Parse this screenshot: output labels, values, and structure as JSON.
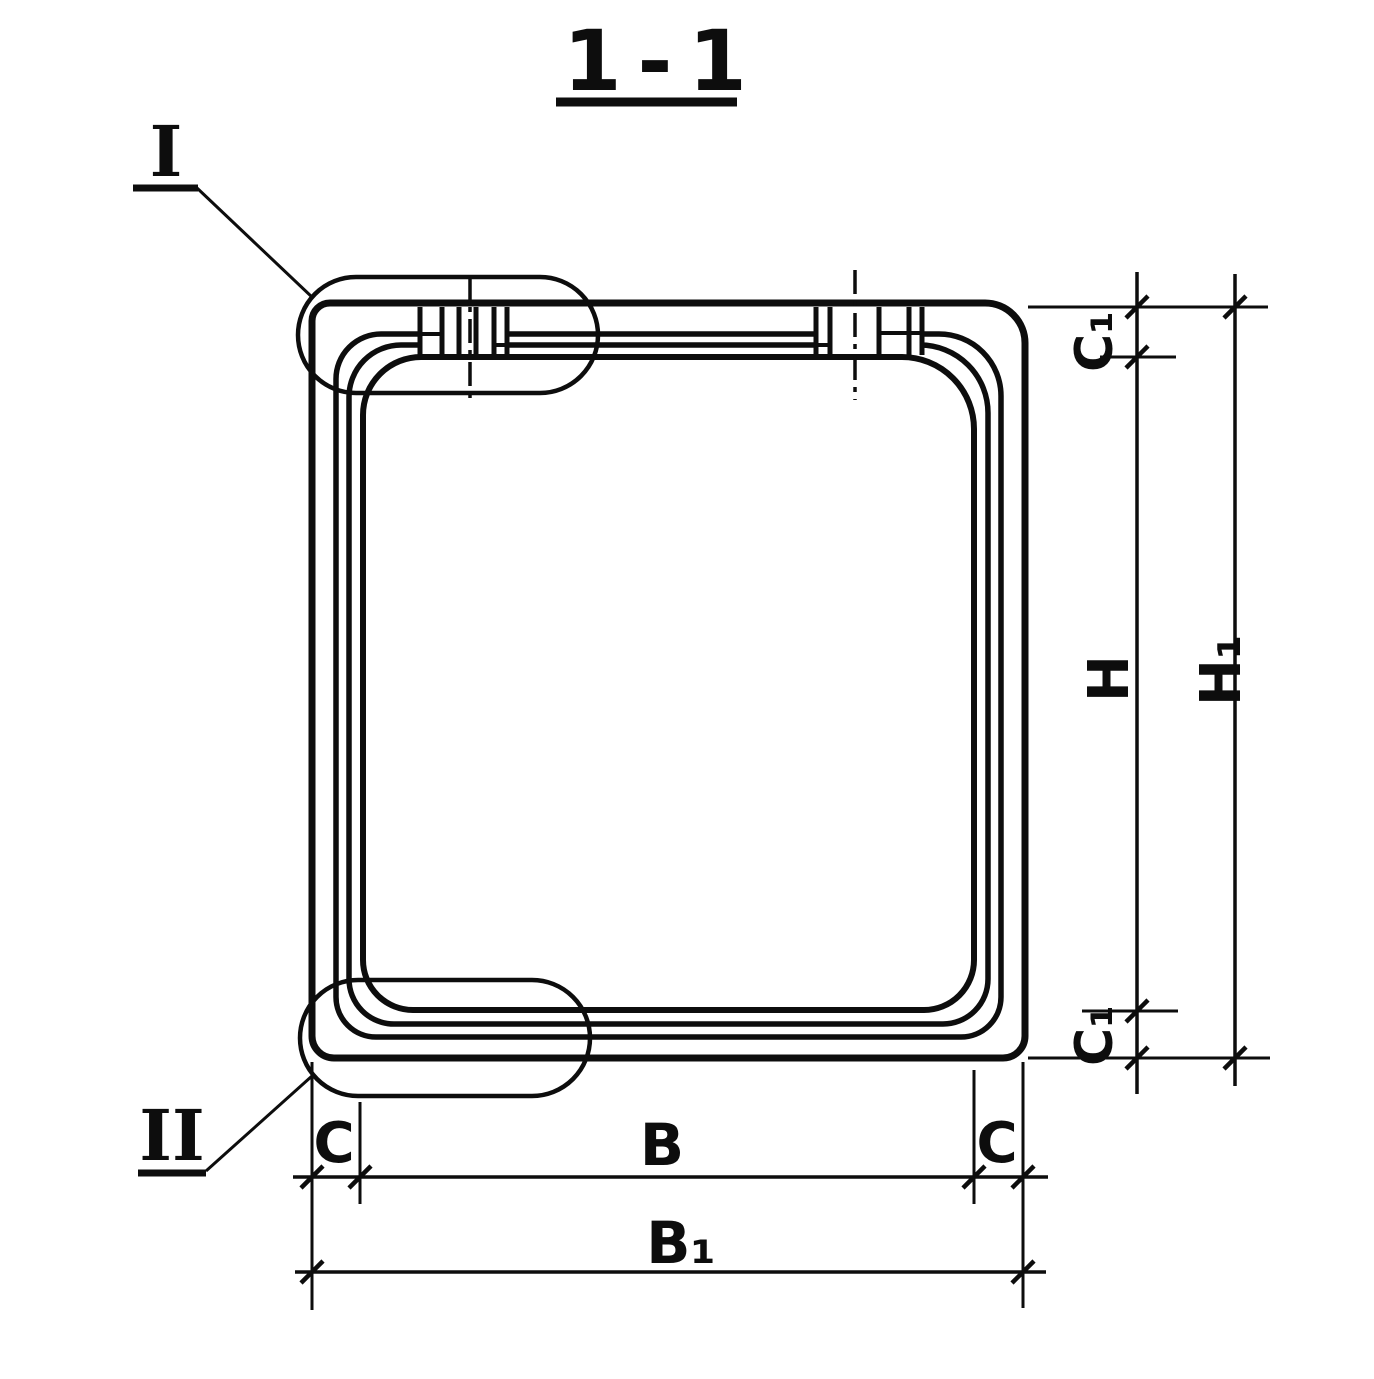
{
  "drawing": {
    "title": "1-1",
    "ink_color": "#0d0d0d",
    "paper_color": "#ffffff"
  },
  "callouts": {
    "detail_one": "I",
    "detail_two": "II"
  },
  "dims": {
    "c1_top": "C₁",
    "h": "H",
    "h1": "H₁",
    "c1_bottom": "C₁",
    "c_left": "C",
    "b": "B",
    "c_right": "C",
    "b1": "B₁"
  }
}
